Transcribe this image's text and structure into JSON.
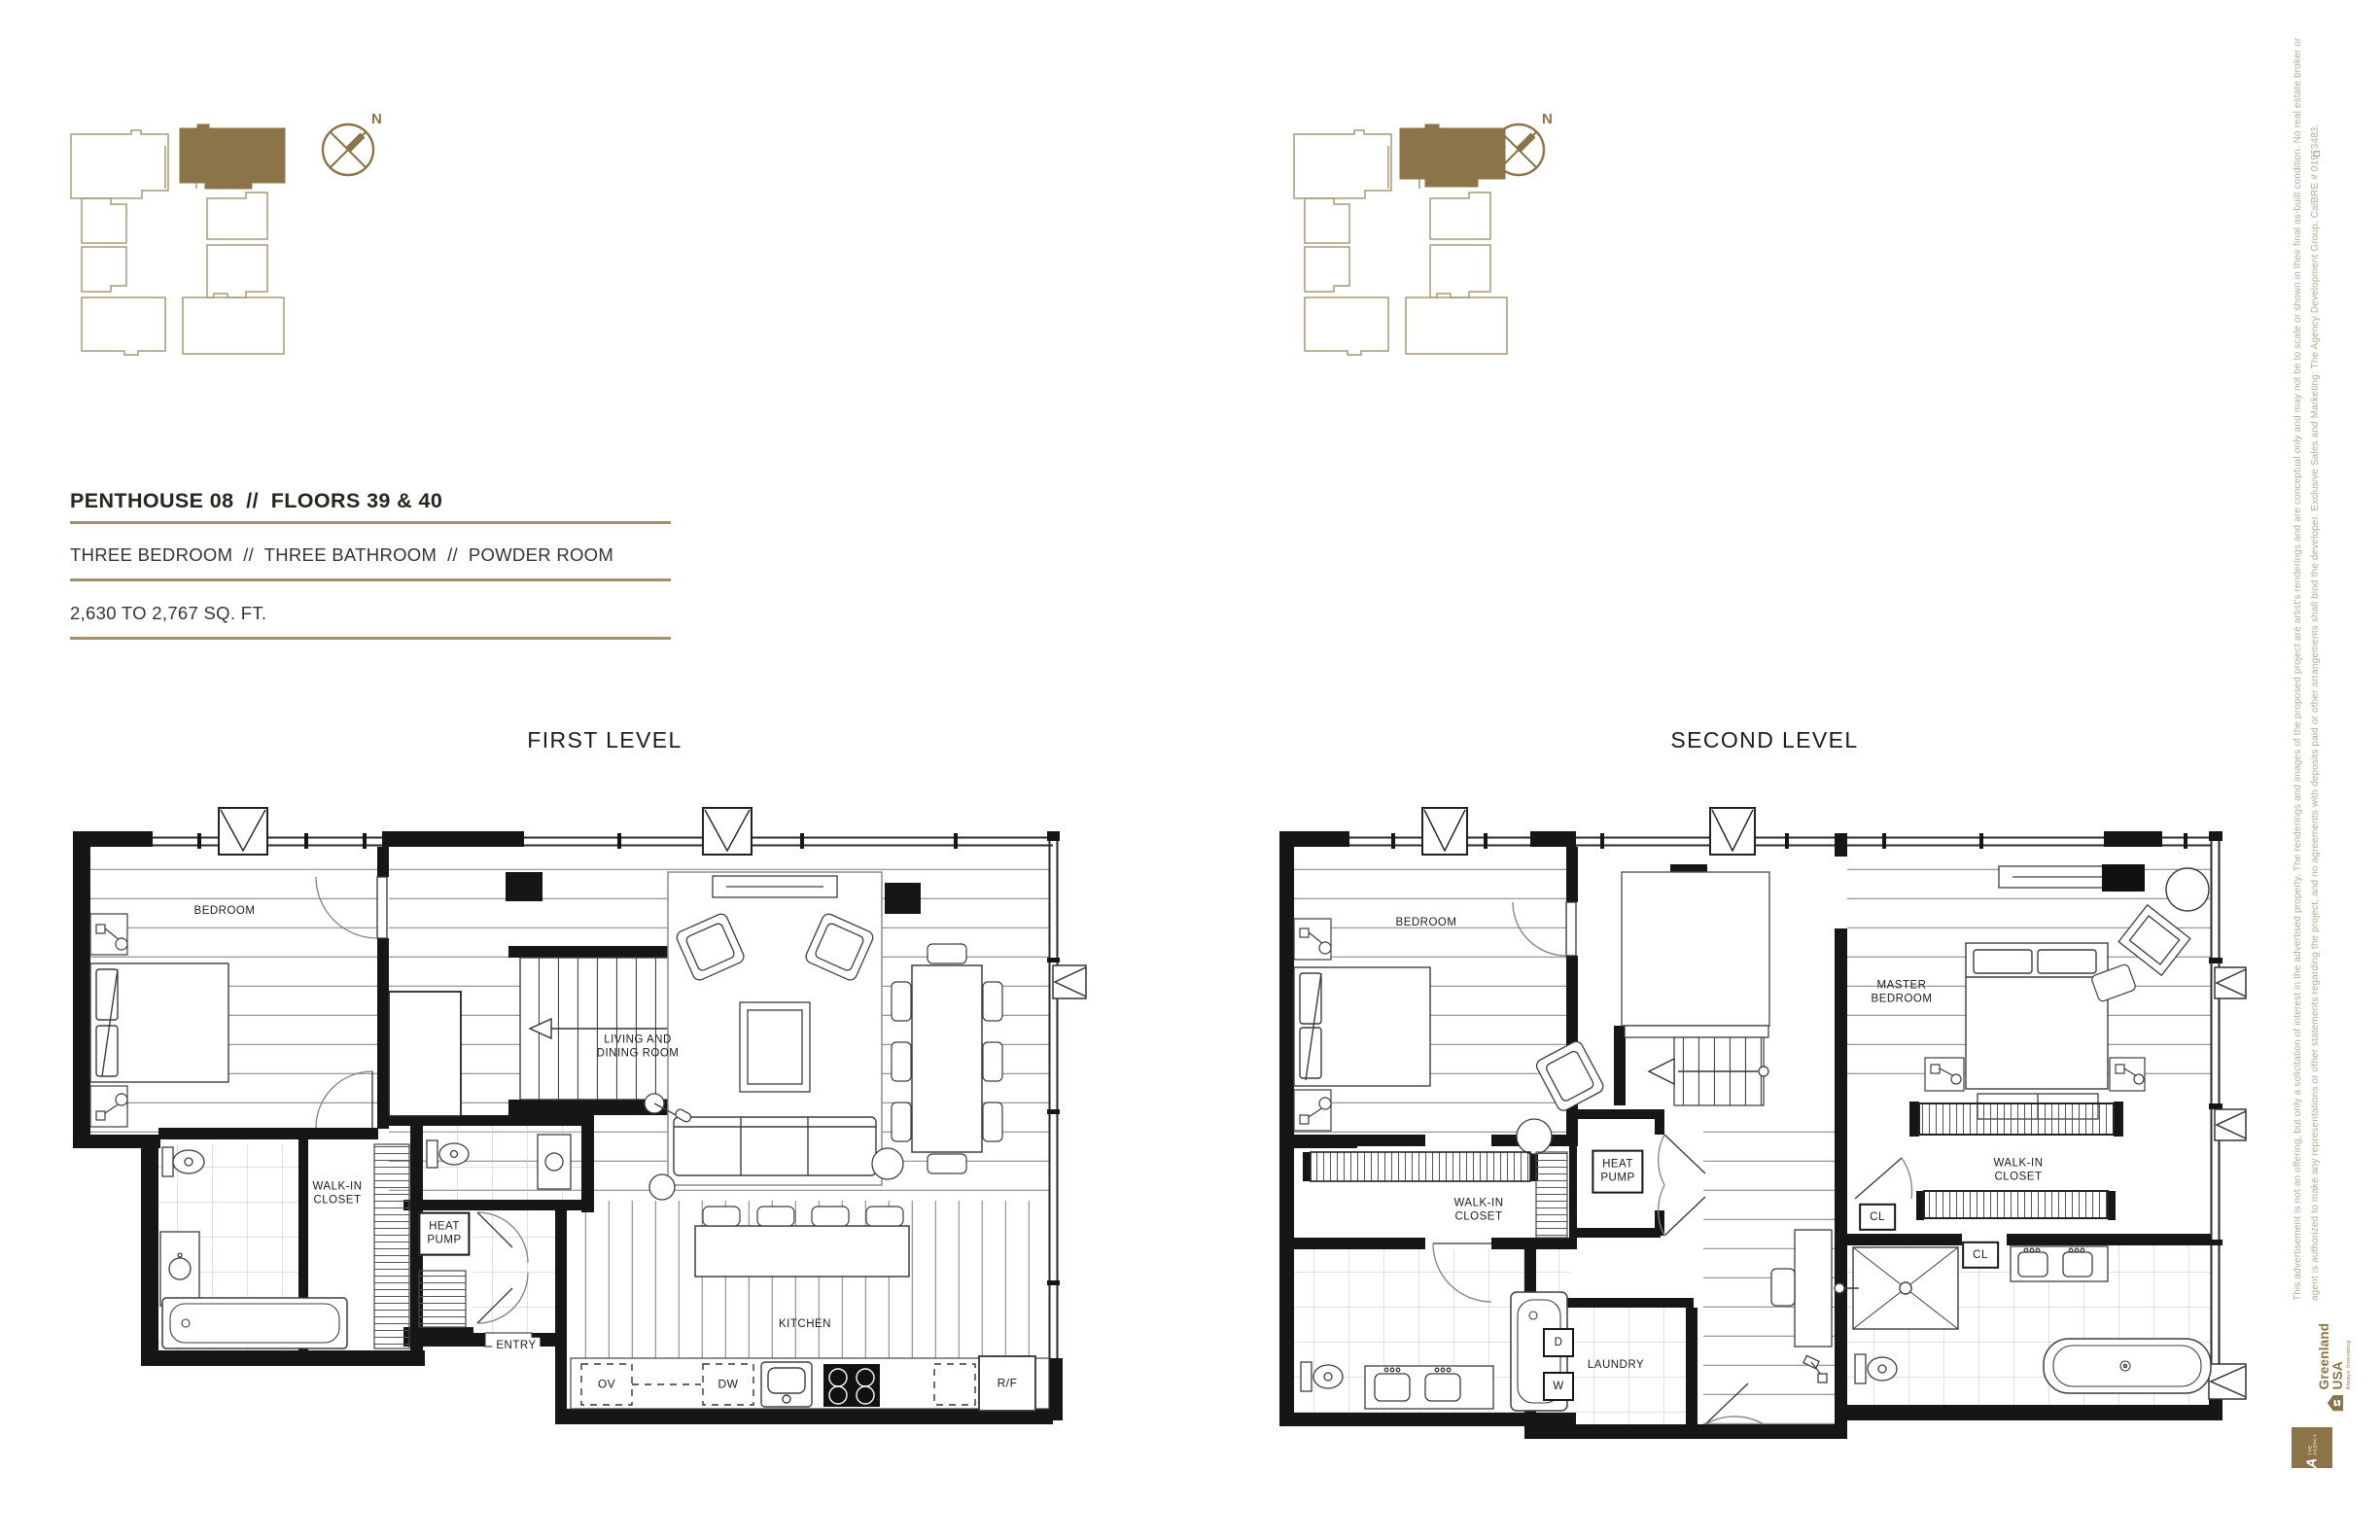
{
  "page": {
    "accent_gold": "#a3906a",
    "dark_gold": "#8a7448",
    "ink": "#29241f",
    "plan_ink": "#161616",
    "muted_gold": "#b7ab90"
  },
  "header": {
    "title": "PENTHOUSE 08  //  FLOORS 39 & 40",
    "features": "THREE BEDROOM  //  THREE BATHROOM  //  POWDER ROOM",
    "area": "2,630 TO 2,767 SQ. FT."
  },
  "compass": {
    "label": "N"
  },
  "levels": {
    "first": {
      "title": "FIRST LEVEL",
      "labels": {
        "bedroom": "BEDROOM",
        "living_dining": "LIVING AND\nDINING ROOM",
        "walk_in_closet": "WALK-IN\nCLOSET",
        "heat_pump": "HEAT\nPUMP",
        "entry": "ENTRY",
        "kitchen": "KITCHEN",
        "oven": "OV",
        "dishwasher": "DW",
        "refrigerator": "R/F"
      }
    },
    "second": {
      "title": "SECOND LEVEL",
      "labels": {
        "bedroom": "BEDROOM",
        "master_bedroom": "MASTER\nBEDROOM",
        "walk_in_closet_left": "WALK-IN\nCLOSET",
        "heat_pump": "HEAT\nPUMP",
        "walk_in_closet_right": "WALK-IN\nCLOSET",
        "closet_upper": "CL",
        "closet_lower": "CL",
        "laundry": "LAUNDRY",
        "dryer": "D",
        "washer": "W"
      }
    }
  },
  "legal": {
    "line1": "This advertisement is not an offering, but only a solicitation of interest in the advertised property. The renderings and images of the proposed project are artist's renderings and are conceptual only and may not be to scale or shown in their final as-built condition. No real estate broker or",
    "line2": "agent is authorized to make any representations or other statements regarding the project, and no agreements with deposits paid or other arrangements shall bind the developer. Exclusive Sales and Marketing: The Agency Development Group. CalBRE # 01973483."
  },
  "branding": {
    "greenland_name": "Greenland USA",
    "greenland_tagline": "Always Innovating",
    "agency_name": "THE AGENCY",
    "agency_monogram": "A"
  },
  "icons": {
    "equal_housing": "⌂"
  }
}
